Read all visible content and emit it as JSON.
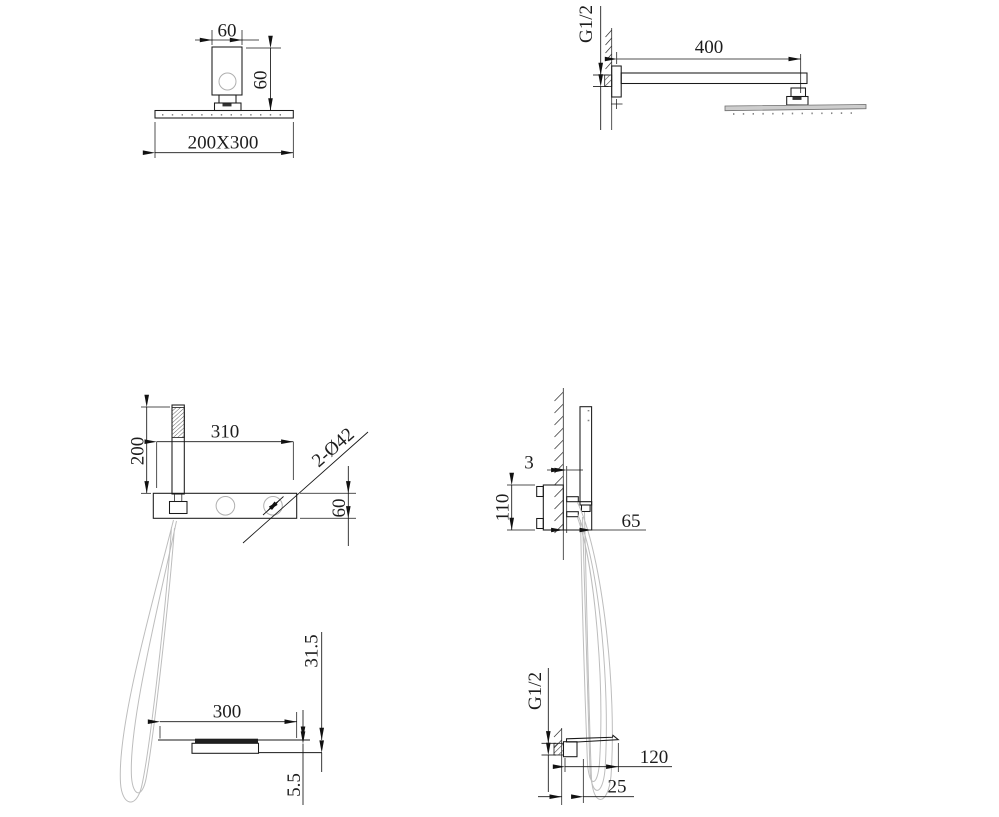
{
  "views": {
    "overhead_front": {
      "dim_bracket_width": "60",
      "dim_bracket_height": "60",
      "dim_head_face": "200X300"
    },
    "overhead_side": {
      "thread_label": "G1/2",
      "dim_arm_length": "400"
    },
    "panel_front": {
      "dim_handshower_height": "200",
      "dim_panel_width": "310",
      "dim_knob_holes": "2-Ø42",
      "dim_panel_height": "60",
      "dim_spout_drop": "31.5",
      "dim_spout_width": "300",
      "dim_spout_plate": "5.5"
    },
    "panel_side": {
      "dim_panel_thickness": "3",
      "dim_valve_height": "110",
      "dim_shelf_depth": "65",
      "thread_label": "G1/2",
      "dim_spout_length": "120",
      "dim_spout_body": "25"
    }
  },
  "colors": {
    "background": "#ffffff",
    "line": "#1a1a1a",
    "dimension": "#161616",
    "hose_gray": "#bdbdbd",
    "plate_fill": "#cdcdcd",
    "slot_fill": "#1f1f1f"
  }
}
